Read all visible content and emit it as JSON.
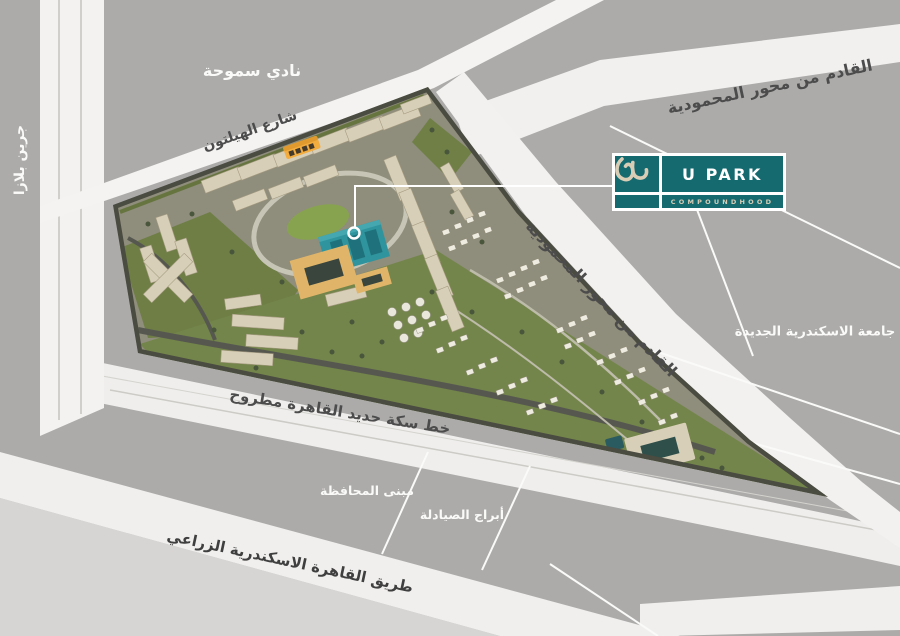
{
  "map": {
    "colors": {
      "background_gray": "#ACABAA",
      "light_area": "#D6D5D3",
      "road_white": "#F2F1EF",
      "site_highlight_teal": "#2F949D",
      "site_orange": "#E0B56A"
    },
    "labels": {
      "smouha_club": "نادي سموحة",
      "green_plaza": "جرين بلازا",
      "hilton_street": "شارع الهيلتون",
      "from_mahmoudia_axis_top": "القادم من محور المحمودية",
      "from_mahmoudia_axis_side": "القادم من محور المحمودية",
      "new_alexandria_university": "جامعة الاسكندرية الجديدة",
      "railway_line": "خط سكة حديد القاهرة مطروح",
      "governorate_building": "مبنى المحافظة",
      "pharmacists_towers": "أبراج الصيادلة",
      "agricultural_road": "طريق القاهرة الاسكندرية الزراعي"
    },
    "logo": {
      "name": "U PARK",
      "tagline": "COMPOUNDHOOD",
      "teal": "#156A70",
      "cream": "#D9CDB6"
    }
  }
}
